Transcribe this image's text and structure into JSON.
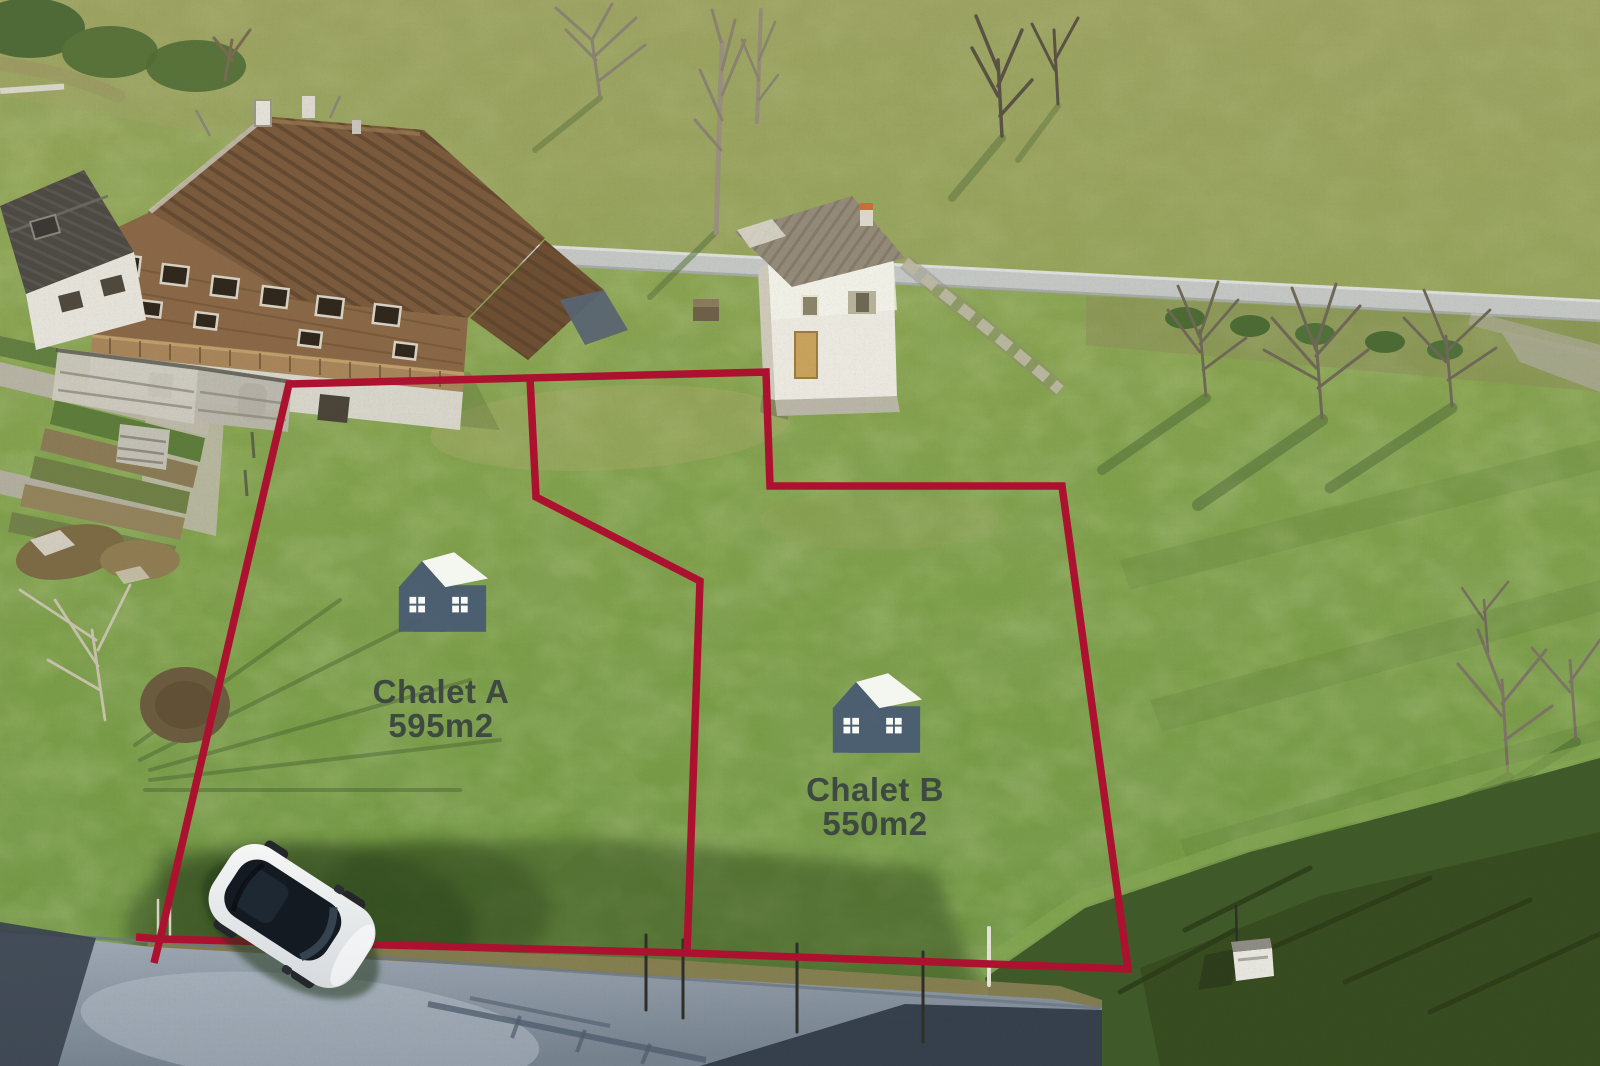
{
  "image": {
    "kind": "aerial-drone-photograph",
    "width_px": 1600,
    "height_px": 1066,
    "description": "Aerial view of a sloping green meadow in an alpine village: two building plots outlined in red beside a large wooden chalet, a small white outbuilding, terraced vegetable gardens, bare winter trees, an upper country road, a lower asphalt road and a parked white car"
  },
  "overlay": {
    "boundary_color": "#ac1130",
    "label_color": "#3a4541",
    "icon_body_color": "#4a5c73",
    "icon_roof_color": "#fbfbf9",
    "parcels": [
      {
        "name": "Chalet A",
        "area": "595m2"
      },
      {
        "name": "Chalet B",
        "area": "550m2"
      }
    ]
  },
  "scene": {
    "grass_green": "#7fa04c",
    "dry_grass": "#a4a766",
    "upper_road_gray": "#c4c7c5",
    "lower_road_gray": "#8e99a8",
    "chalet_roof_brown": "#7b5a3c",
    "chalet_wood_brown": "#8a6746",
    "white_building": "#ece9e1",
    "car_white": "#f2f4f3",
    "car_glass_black": "#141a21",
    "shadow_green": "#33491f"
  }
}
